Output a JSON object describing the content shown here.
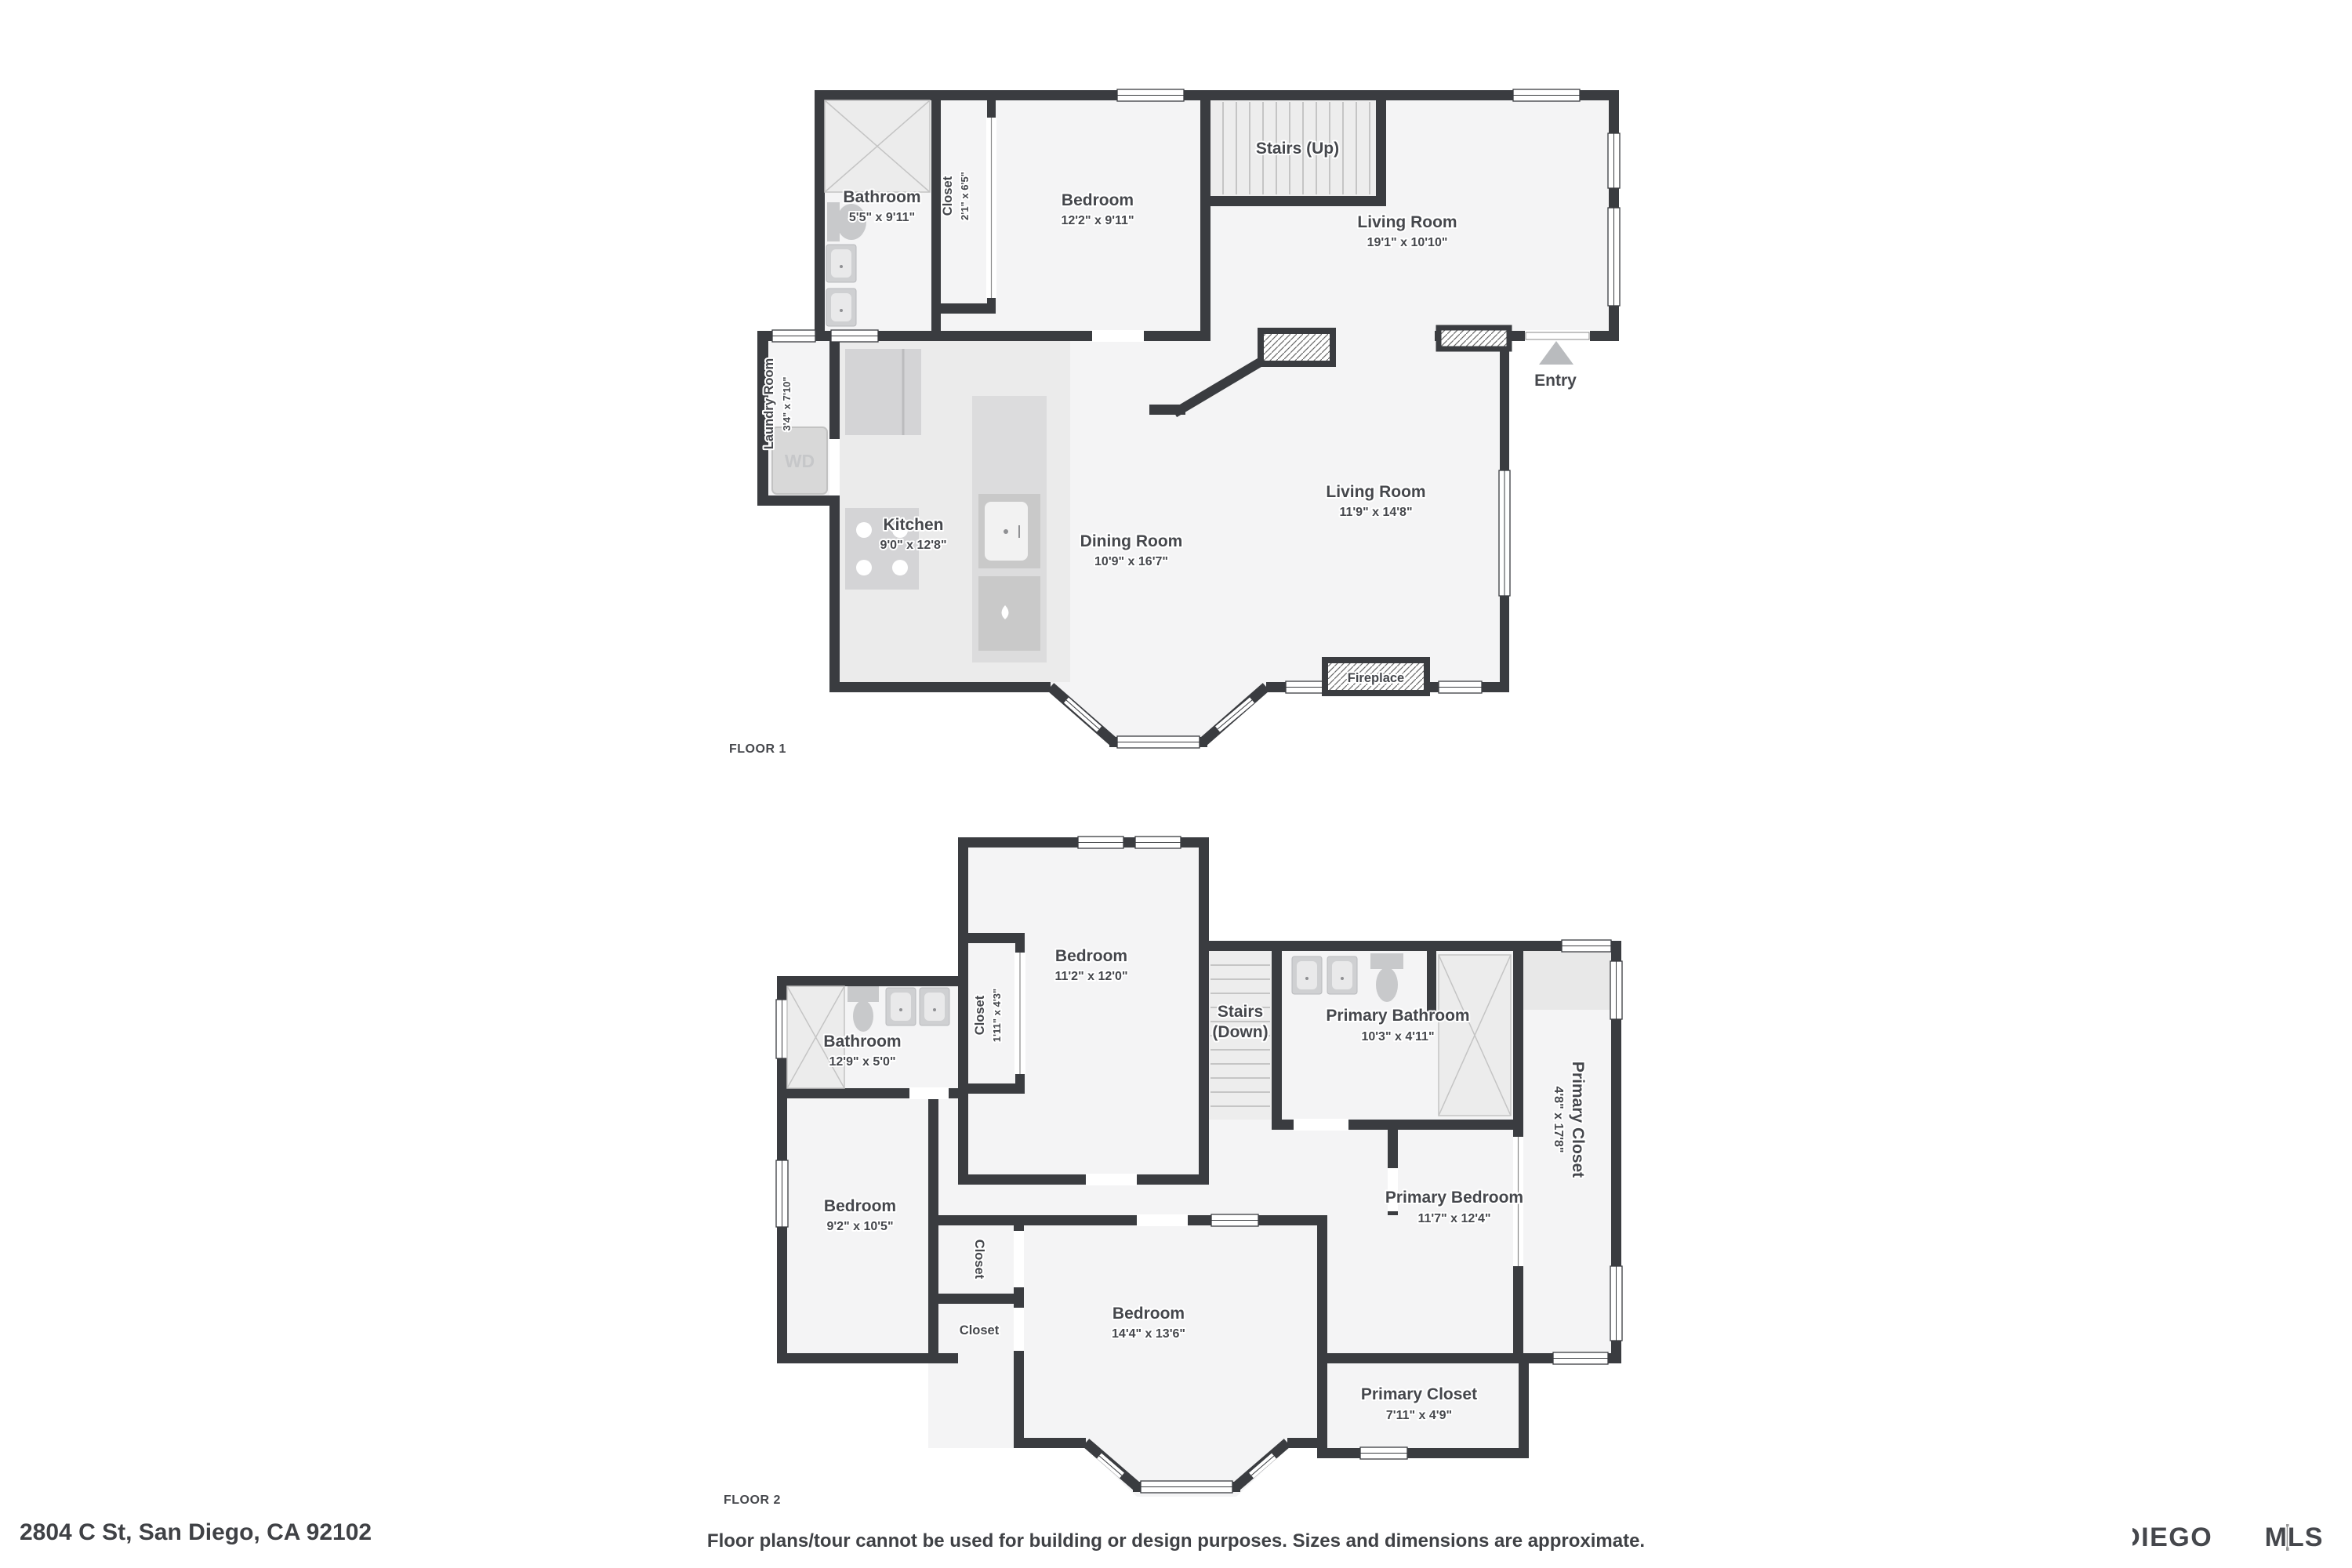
{
  "address": "2804 C St, San Diego, CA 92102",
  "disclaimer": "Floor plans/tour cannot be used for building or design purposes. Sizes and dimensions are approximate.",
  "logo": {
    "primary": "SAN DIEGO",
    "secondary": "MLS"
  },
  "colors": {
    "wall": "#3a3c40",
    "room_fill": "#f4f4f5",
    "kitchen_fill": "#ebebeb",
    "fixture": "#cfd0d2",
    "label": "#45474c",
    "entry_arrow": "#b9bbbe"
  },
  "floor1": {
    "label": "FLOOR 1",
    "rooms": {
      "bathroom": {
        "name": "Bathroom",
        "dims": "5'5\" x 9'11\""
      },
      "closet": {
        "name": "Closet",
        "dims": "2'1\" x 6'5\""
      },
      "bedroom": {
        "name": "Bedroom",
        "dims": "12'2\" x 9'11\""
      },
      "stairs": {
        "name": "Stairs (Up)"
      },
      "living_upper": {
        "name": "Living Room",
        "dims": "19'1\" x 10'10\""
      },
      "laundry": {
        "name": "Laundry Room",
        "dims": "3'4\" x 7'10\"",
        "appliance": "WD"
      },
      "kitchen": {
        "name": "Kitchen",
        "dims": "9'0\" x 12'8\""
      },
      "dining": {
        "name": "Dining Room",
        "dims": "10'9\" x 16'7\""
      },
      "living_lower": {
        "name": "Living Room",
        "dims": "11'9\" x 14'8\""
      },
      "fireplace": {
        "name": "Fireplace"
      },
      "entry": {
        "name": "Entry"
      }
    }
  },
  "floor2": {
    "label": "FLOOR 2",
    "rooms": {
      "bedroom_top": {
        "name": "Bedroom",
        "dims": "11'2\" x 12'0\""
      },
      "closet_top": {
        "name": "Closet",
        "dims": "1'11\" x 4'3\""
      },
      "stairs": {
        "name_line1": "Stairs",
        "name_line2": "(Down)"
      },
      "primary_bathroom": {
        "name": "Primary Bathroom",
        "dims": "10'3\" x 4'11\""
      },
      "bathroom": {
        "name": "Bathroom",
        "dims": "12'9\" x 5'0\""
      },
      "primary_closet": {
        "name": "Primary Closet",
        "dims": "4'8\" x 17'8\""
      },
      "bedroom_left": {
        "name": "Bedroom",
        "dims": "9'2\" x 10'5\""
      },
      "closet_mid_1": {
        "name": "Closet"
      },
      "closet_mid_2": {
        "name": "Closet"
      },
      "bedroom_lower": {
        "name": "Bedroom",
        "dims": "14'4\" x 13'6\""
      },
      "primary_bedroom": {
        "name": "Primary Bedroom",
        "dims": "11'7\" x 12'4\""
      },
      "primary_closet_2": {
        "name": "Primary Closet",
        "dims": "7'11\" x 4'9\""
      }
    }
  }
}
